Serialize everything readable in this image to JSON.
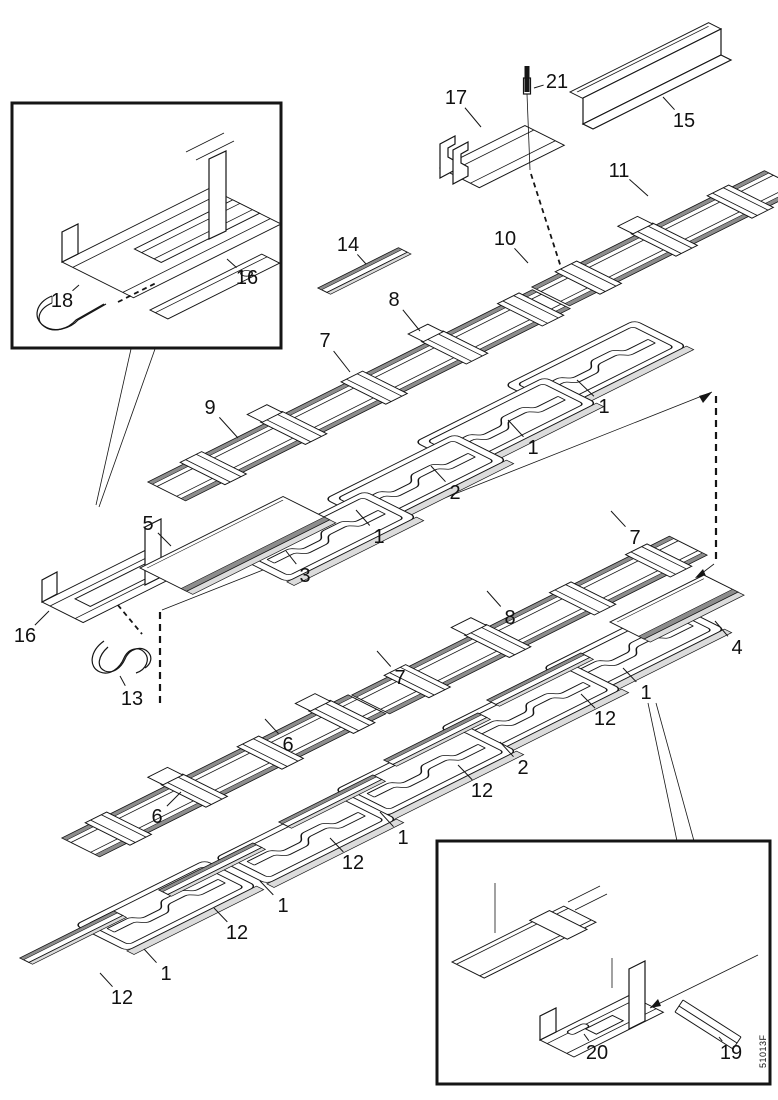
{
  "figure": {
    "type": "exploded-parts-diagram",
    "code": "51013F",
    "callouts": [
      {
        "label": "17",
        "x": 456,
        "y": 97,
        "tx": 481,
        "ty": 127
      },
      {
        "label": "21",
        "x": 557,
        "y": 81,
        "tx": 534,
        "ty": 88
      },
      {
        "label": "15",
        "x": 684,
        "y": 120,
        "tx": 663,
        "ty": 97
      },
      {
        "label": "11",
        "x": 619,
        "y": 170,
        "tx": 648,
        "ty": 196
      },
      {
        "label": "10",
        "x": 505,
        "y": 238,
        "tx": 528,
        "ty": 263
      },
      {
        "label": "14",
        "x": 348,
        "y": 244,
        "tx": 366,
        "ty": 264
      },
      {
        "label": "8",
        "x": 394,
        "y": 299,
        "tx": 420,
        "ty": 331
      },
      {
        "label": "7",
        "x": 325,
        "y": 340,
        "tx": 350,
        "ty": 372
      },
      {
        "label": "9",
        "x": 210,
        "y": 407,
        "tx": 238,
        "ty": 438
      },
      {
        "label": "18",
        "x": 62,
        "y": 300,
        "tx": 79,
        "ty": 285
      },
      {
        "label": "16",
        "x": 247,
        "y": 277,
        "tx": 227,
        "ty": 259
      },
      {
        "label": "1",
        "x": 604,
        "y": 406,
        "tx": 577,
        "ty": 380
      },
      {
        "label": "1",
        "x": 533,
        "y": 447,
        "tx": 508,
        "ty": 420
      },
      {
        "label": "2",
        "x": 455,
        "y": 492,
        "tx": 431,
        "ty": 466
      },
      {
        "label": "1",
        "x": 379,
        "y": 536,
        "tx": 356,
        "ty": 510
      },
      {
        "label": "3",
        "x": 305,
        "y": 575,
        "tx": 286,
        "ty": 551
      },
      {
        "label": "5",
        "x": 148,
        "y": 523,
        "tx": 171,
        "ty": 546
      },
      {
        "label": "16",
        "x": 25,
        "y": 635,
        "tx": 49,
        "ty": 611
      },
      {
        "label": "13",
        "x": 132,
        "y": 698,
        "tx": 120,
        "ty": 676
      },
      {
        "label": "7",
        "x": 635,
        "y": 537,
        "tx": 611,
        "ty": 511
      },
      {
        "label": "8",
        "x": 510,
        "y": 617,
        "tx": 487,
        "ty": 591
      },
      {
        "label": "7",
        "x": 400,
        "y": 677,
        "tx": 377,
        "ty": 651
      },
      {
        "label": "4",
        "x": 737,
        "y": 647,
        "tx": 715,
        "ty": 621
      },
      {
        "label": "1",
        "x": 646,
        "y": 692,
        "tx": 623,
        "ty": 668
      },
      {
        "label": "12",
        "x": 605,
        "y": 718,
        "tx": 581,
        "ty": 694
      },
      {
        "label": "6",
        "x": 288,
        "y": 744,
        "tx": 265,
        "ty": 719
      },
      {
        "label": "2",
        "x": 523,
        "y": 767,
        "tx": 500,
        "ty": 742
      },
      {
        "label": "12",
        "x": 482,
        "y": 790,
        "tx": 458,
        "ty": 765
      },
      {
        "label": "6",
        "x": 157,
        "y": 816,
        "tx": 181,
        "ty": 792
      },
      {
        "label": "1",
        "x": 403,
        "y": 837,
        "tx": 380,
        "ty": 812
      },
      {
        "label": "12",
        "x": 353,
        "y": 862,
        "tx": 330,
        "ty": 838
      },
      {
        "label": "1",
        "x": 283,
        "y": 905,
        "tx": 260,
        "ty": 881
      },
      {
        "label": "12",
        "x": 237,
        "y": 932,
        "tx": 214,
        "ty": 908
      },
      {
        "label": "1",
        "x": 166,
        "y": 973,
        "tx": 144,
        "ty": 949
      },
      {
        "label": "12",
        "x": 122,
        "y": 997,
        "tx": 100,
        "ty": 973
      },
      {
        "label": "20",
        "x": 597,
        "y": 1052,
        "tx": 584,
        "ty": 1034
      },
      {
        "label": "19",
        "x": 731,
        "y": 1052,
        "tx": 719,
        "ty": 1037
      }
    ],
    "insets": [
      {
        "name": "rail-connector-detail",
        "labels": [
          "18",
          "16"
        ]
      },
      {
        "name": "rail-splice-detail",
        "labels": [
          "20",
          "19"
        ]
      }
    ]
  }
}
